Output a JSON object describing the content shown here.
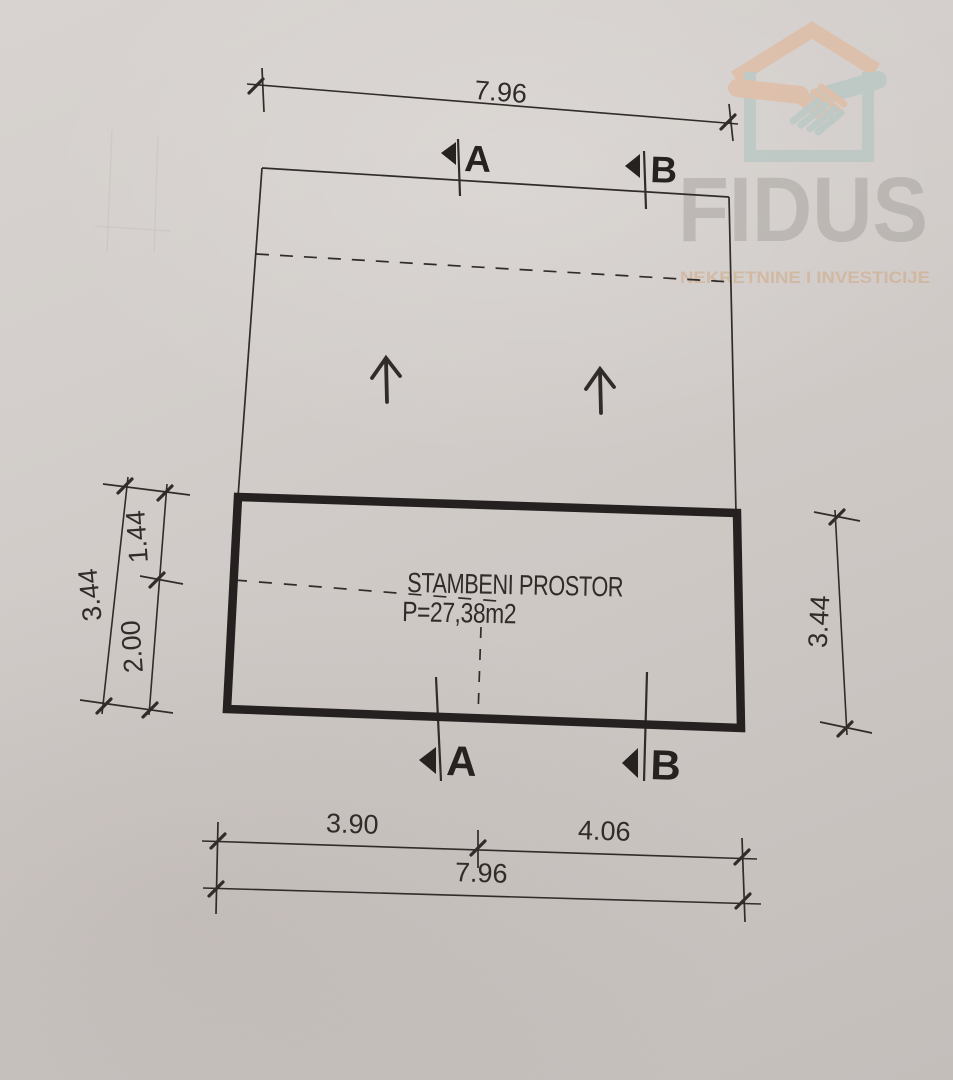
{
  "watermark": {
    "brand": "FIDUS",
    "tagline": "NEKRETNINE I INVESTICIJE",
    "colors": {
      "roof_and_left_hand": "#e5b18b",
      "walls_and_right_hand": "#a9c2bd",
      "brand_text": "#97918e",
      "tagline_text": "#cf9a69"
    }
  },
  "plan": {
    "room": {
      "name": "STAMBENI PROSTOR",
      "area": "P=27,38m2"
    },
    "sections": {
      "a": "A",
      "b": "B"
    },
    "dimensions": {
      "top_total": "7.96",
      "left_upper": "1.44",
      "left_lower": "2.00",
      "left_total": "3.44",
      "right_total": "3.44",
      "bottom_left": "3.90",
      "bottom_right": "4.06",
      "bottom_total": "7.96"
    },
    "ink_color": "#302c29"
  }
}
